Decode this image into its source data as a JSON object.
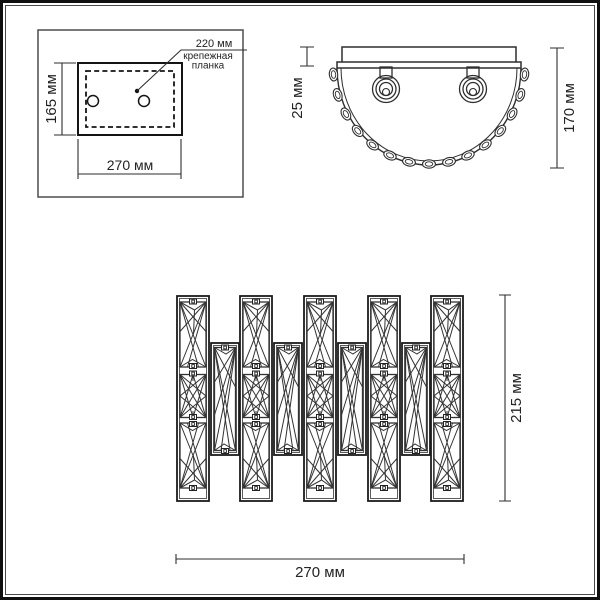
{
  "drawing": {
    "type": "wall-lamp dimensional drawing",
    "units": "мм"
  },
  "views": {
    "mounting_plate": {
      "callout_dim": "220 мм",
      "callout_label_line1": "крепежная",
      "callout_label_line2": "планка",
      "height_dim": "165 мм",
      "width_dim": "270 мм"
    },
    "top": {
      "plate_depth_dim": "25 мм",
      "total_depth_dim": "170 мм"
    },
    "front": {
      "height_dim": "215 мм",
      "width_dim": "270 мм"
    }
  },
  "colors": {
    "line": "#2e2e2e",
    "frame_dark": "#101010",
    "frame_light": "#4a4a4a",
    "background": "#ffffff",
    "text": "#232323"
  }
}
